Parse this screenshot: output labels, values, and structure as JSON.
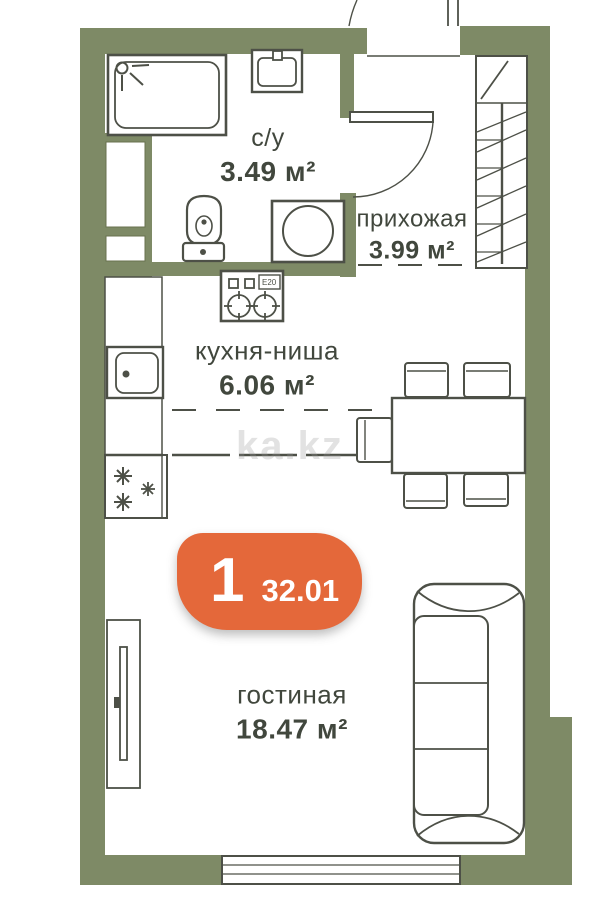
{
  "rooms": {
    "bathroom": {
      "name": "с/у",
      "area": "3.49 м²"
    },
    "hallway": {
      "name": "прихожая",
      "area": "3.99 м²"
    },
    "kitchen": {
      "name": "кухня-ниша",
      "area": "6.06 м²"
    },
    "living": {
      "name": "гостиная",
      "area": "18.47 м²"
    }
  },
  "badge": {
    "rooms_count": "1",
    "total_area": "32.01"
  },
  "stove": {
    "label": "E20"
  },
  "watermark": "ka.kz",
  "icons": {
    "fridge_marks": "snowflake-icon",
    "bathtub_corner": "shower-mixer-icon"
  },
  "colors": {
    "wall": "#7e8a66",
    "line": "#4d5047",
    "text": "#41473d",
    "accent": "#e4683a",
    "bg": "#ffffff"
  }
}
